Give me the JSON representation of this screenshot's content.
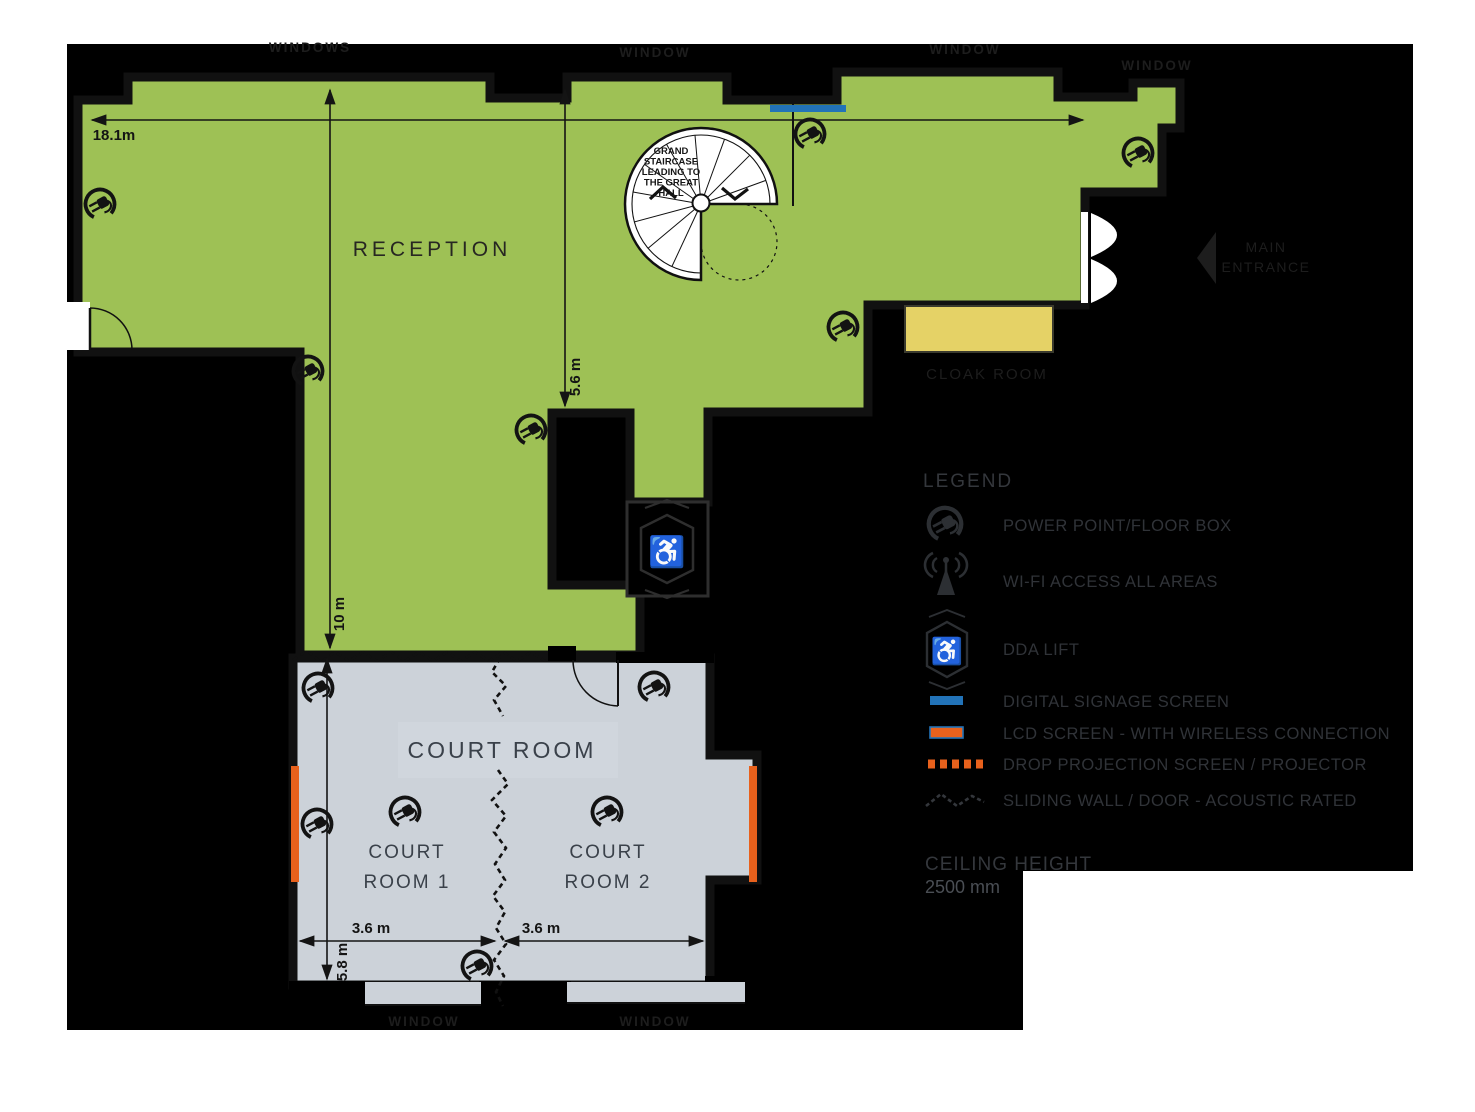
{
  "plan": {
    "rooms": {
      "reception": "RECEPTION",
      "court_room": "COURT ROOM",
      "court_room_1_line1": "COURT",
      "court_room_1_line2": "ROOM 1",
      "court_room_2_line1": "COURT",
      "court_room_2_line2": "ROOM 2",
      "cloak_room": "CLOAK ROOM"
    },
    "staircase_note": {
      "line1": "GRAND",
      "line2": "STAIRCASE",
      "line3": "LEADING TO",
      "line4": "THE GREAT",
      "line5": "HALL"
    },
    "entrance": {
      "line1": "MAIN",
      "line2": "ENTRANCE"
    },
    "window_labels": {
      "top_left": "WINDOWS",
      "top_mid": "WINDOW",
      "top_right": "WINDOW",
      "top_far_right": "WINDOW",
      "bottom_left": "WINDOW",
      "bottom_right": "WINDOW"
    },
    "dimensions": {
      "overall_width": "18.1m",
      "reception_depth": "5.6 m",
      "reception_height": "10 m",
      "court1_width": "3.6 m",
      "court2_width": "3.6 m",
      "court_depth": "5.8 m"
    }
  },
  "legend": {
    "title": "LEGEND",
    "items": [
      {
        "label": "POWER POINT/FLOOR BOX",
        "icon": "power-point-icon"
      },
      {
        "label": "WI-FI ACCESS ALL AREAS",
        "icon": "wifi-antenna-icon"
      },
      {
        "label": "DDA LIFT",
        "icon": "dda-lift-icon"
      },
      {
        "label": "DIGITAL SIGNAGE SCREEN",
        "icon": "digital-signage-swatch"
      },
      {
        "label": "LCD SCREEN - WITH WIRELESS CONNECTION",
        "icon": "lcd-screen-swatch"
      },
      {
        "label": "DROP PROJECTION SCREEN / PROJECTOR",
        "icon": "projection-screen-swatch"
      },
      {
        "label": "SLIDING WALL / DOOR - ACOUSTIC RATED",
        "icon": "sliding-wall-swatch"
      }
    ],
    "ceiling_height_label": "CEILING HEIGHT",
    "ceiling_height_value": "2500 mm"
  },
  "icons": {
    "wheelchair": "♿"
  },
  "colors": {
    "floor_green": "#9ec155",
    "floor_gray": "#ccd2d9",
    "cloak_yellow": "#e5d266",
    "signage_blue": "#2273b8",
    "screen_orange": "#e8611c",
    "background": "#000000"
  }
}
